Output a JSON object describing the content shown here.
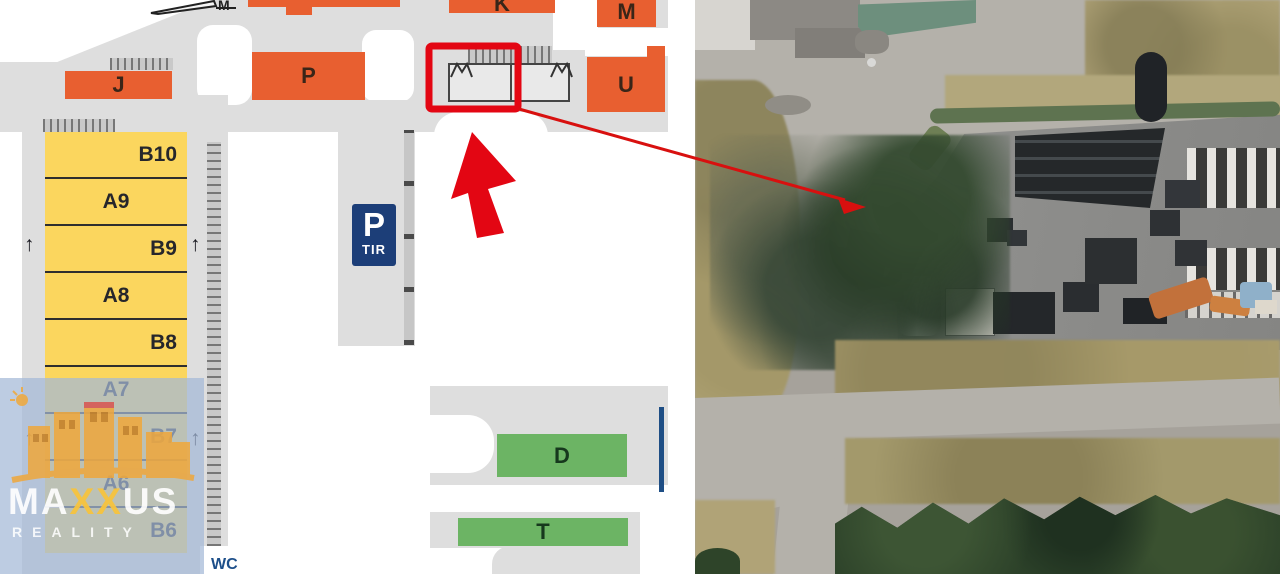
{
  "colors": {
    "map-bg": "#dedede",
    "orange": "#e85f30",
    "yellow": "#fbd65e",
    "green": "#6cb464",
    "red": "#e30613",
    "navy": "#1c3e78"
  },
  "map": {
    "zones": {
      "orange": [
        "J",
        "P",
        "K",
        "M",
        "U"
      ],
      "yellow": [
        "B10",
        "A9",
        "B9",
        "A8",
        "B8",
        "A7",
        "B7",
        "A6",
        "B6"
      ],
      "green": [
        "D",
        "T"
      ],
      "outline_top": "M"
    },
    "parking_sign": {
      "main": "P",
      "sub": "TIR"
    },
    "wc_label": "WC",
    "up_arrow": "↑"
  },
  "watermark": {
    "brand_first": "MA",
    "brand_x": "XX",
    "brand_last": "US",
    "subtitle": "REALITY"
  }
}
